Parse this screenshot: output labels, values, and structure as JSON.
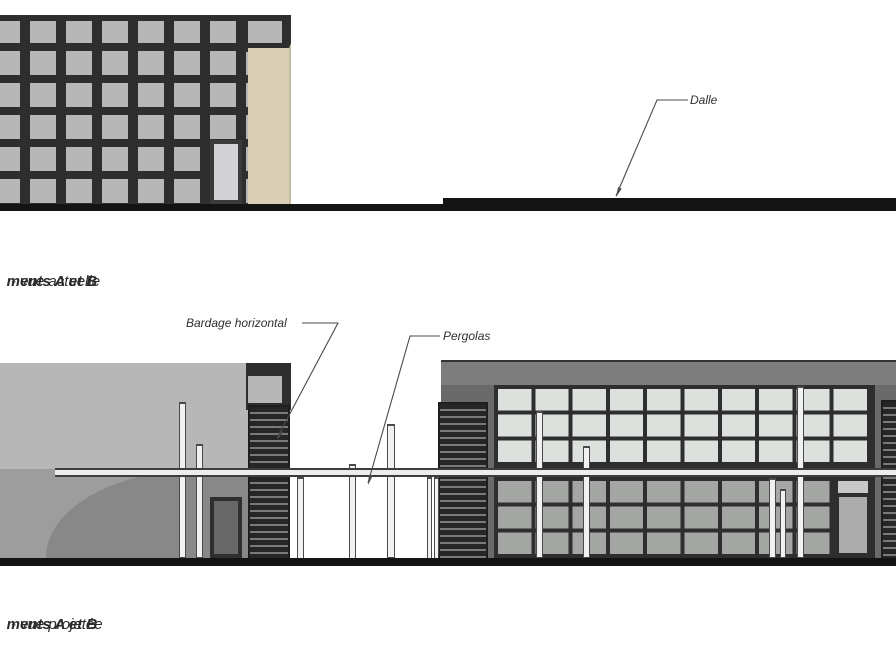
{
  "annotations": {
    "dalle": "Dalle",
    "bardage": "Bardage horizontal",
    "pergolas": "Pergolas"
  },
  "captions": {
    "actual": {
      "name": "ments A et B",
      "suffix": " - vue actuelle"
    },
    "projected": {
      "name": "ments A et B",
      "suffix": " - vue projetée"
    }
  },
  "colors": {
    "frame": "#2e2e2e",
    "panel": "#b7b7b7",
    "panel_shade": "#9d9d9d",
    "beige": "#d8cfb5",
    "wall": "#6a6a6a",
    "parapet": "#7d7d7d",
    "pane_upper": "#dde1de",
    "pane_lower": "#a4a6a3",
    "stripe_dark": "#262626",
    "stripe_light": "#7a7a7a",
    "line": "#141414",
    "post": "#f1f1f1",
    "label": "#2f2f2f"
  }
}
